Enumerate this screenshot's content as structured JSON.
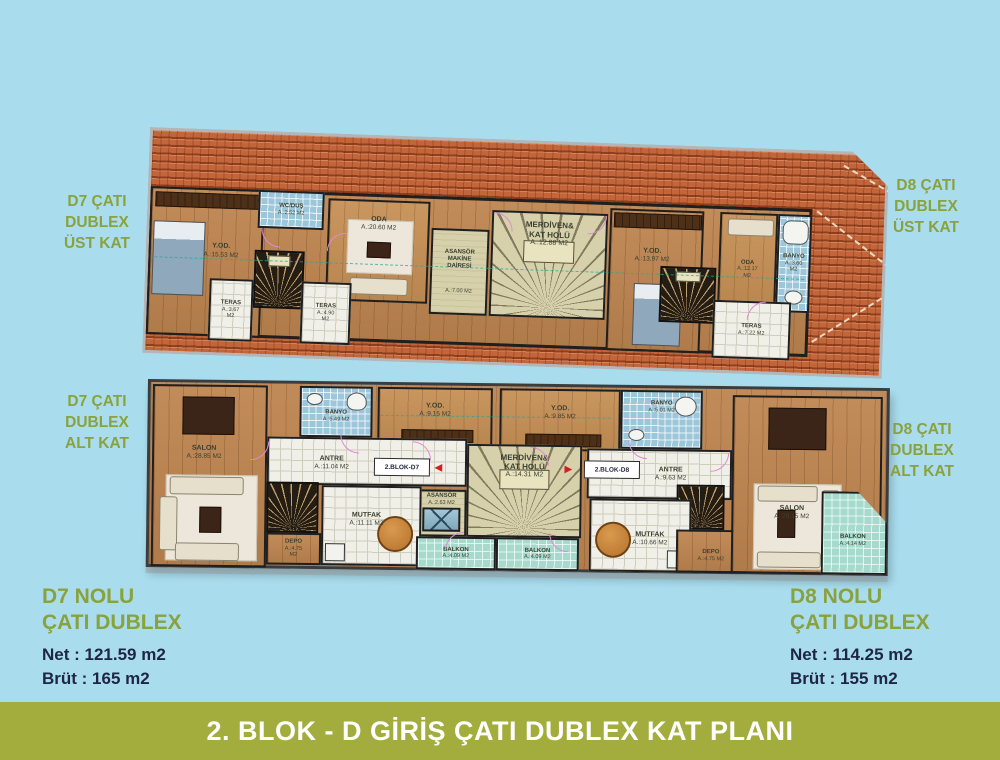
{
  "banner": {
    "text": "2. BLOK - D GİRİŞ ÇATI DUBLEX KAT PLANI"
  },
  "side_labels": {
    "d7_upper": "D7 ÇATI\nDUBLEX\nÜST KAT",
    "d8_upper": "D8 ÇATI\nDUBLEX\nÜST KAT",
    "d7_lower": "D7 ÇATI\nDUBLEX\nALT KAT",
    "d8_lower": "D8 ÇATI\nDUBLEX\nALT KAT"
  },
  "summaries": {
    "d7": {
      "title": "D7 NOLU\nÇATI DUBLEX",
      "net": "Net : 121.59 m2",
      "brut": "Brüt : 165 m2"
    },
    "d8": {
      "title": "D8 NOLU\nÇATI DUBLEX",
      "net": "Net : 114.25 m2",
      "brut": "Brüt : 155 m2"
    }
  },
  "plans": {
    "upper": {
      "rooms": [
        {
          "name": "Y.OD.",
          "area": "A.:15.53 M2"
        },
        {
          "name": "WC/DUŞ",
          "area": "A.:2.52 M2"
        },
        {
          "name": "ODA",
          "area": "A.:20.60 M2"
        },
        {
          "name": "TERAS",
          "area": "A.:3.67 M2"
        },
        {
          "name": "TERAS",
          "area": "A.:4.90 M2"
        },
        {
          "name": "ASANSÖR\nMAKİNE DAİRESİ",
          "area": "A.:7.00 M2"
        },
        {
          "name": "MERDİVEN&\nKAT HOLÜ",
          "area": "A.:12.88 M2"
        },
        {
          "name": "Y.OD.",
          "area": "A.:13.97 M2"
        },
        {
          "name": "ODA",
          "area": "A.:12.17 M2"
        },
        {
          "name": "BANYO",
          "area": "A.:3.60 M2"
        },
        {
          "name": "TERAS",
          "area": "A.:7.22 M2"
        }
      ]
    },
    "lower": {
      "rooms": [
        {
          "name": "SALON",
          "area": "A.:28.85 M2"
        },
        {
          "name": "BANYO",
          "area": "A.:5.49 M2"
        },
        {
          "name": "Y.OD.",
          "area": "A.:9.15 M2"
        },
        {
          "name": "Y.OD.",
          "area": "A.:9.85 M2"
        },
        {
          "name": "BANYO",
          "area": "A.:5.01 M2"
        },
        {
          "name": "ANTRE",
          "area": "A.:11.04 M2"
        },
        {
          "name": "ASANSÖR",
          "area": "A.:2.63 M2"
        },
        {
          "name": "MERDİVEN&\nKAT HOLÜ",
          "area": "A.:14.31 M2"
        },
        {
          "name": "MUTFAK",
          "area": "A.:11.11 M2"
        },
        {
          "name": "DEPO",
          "area": "A.:4.75 M2"
        },
        {
          "name": "BALKON",
          "area": "A.:4.09 M2"
        },
        {
          "name": "BALKON",
          "area": "A.:4.09 M2"
        },
        {
          "name": "ANTRE",
          "area": "A.:9.63 M2"
        },
        {
          "name": "MUTFAK",
          "area": "A.:10.66 M2"
        },
        {
          "name": "DEPO",
          "area": "A.:4.75 M2"
        },
        {
          "name": "SALON",
          "area": "A.:28.15 M2"
        },
        {
          "name": "BALKON",
          "area": "A.:4.14 M2"
        }
      ],
      "entries": {
        "d7": "2.BLOK-D7",
        "d8": "2.BLOK-D8"
      }
    }
  },
  "icons": {
    "entry_arrow_left": "◄",
    "entry_arrow_right": "►"
  },
  "colors": {
    "background": "#a9ddee",
    "olive": "#8aa23d",
    "banner": "#a3ad3e",
    "navy": "#1e2545",
    "roof": "#c3653a",
    "arrow_red": "#d21f1f"
  }
}
